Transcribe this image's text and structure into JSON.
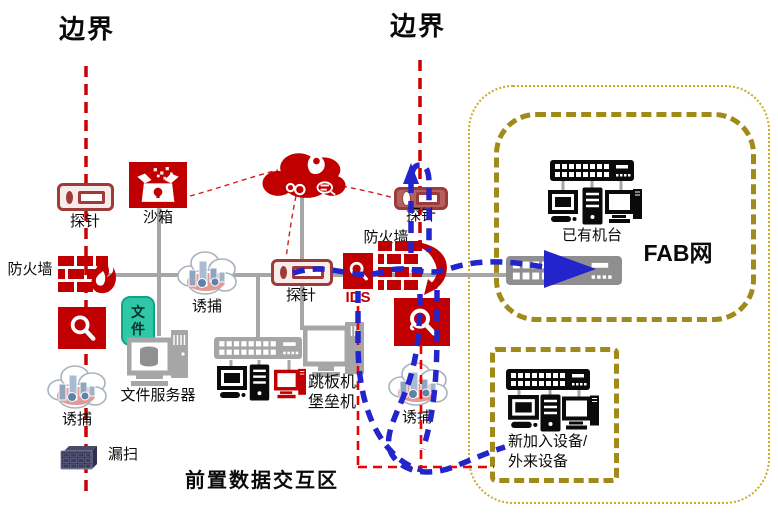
{
  "colors": {
    "accent_red": "#C00000",
    "probe_border_red": "#9E3A38",
    "detour_red": "#EE0000",
    "flow_blue": "#2424CC",
    "zone_olive": "#A18A1A",
    "zone_olive_dotted": "#C9AC28",
    "connector_gray": "#A6A6A6",
    "device_black": "#0A0A0A",
    "file_tag_teal": "#2EC8A6"
  },
  "labels": {
    "boundary_left": "边界",
    "boundary_right": "边界",
    "probe_left": "探针",
    "probe_center": "探针",
    "probe_right": "探针",
    "sandbox": "沙箱",
    "firewall_left": "防火墙",
    "firewall_right": "防火墙",
    "ids": "IDS",
    "decoy_left": "诱捕",
    "decoy_center": "诱捕",
    "decoy_bottom": "诱捕",
    "file_tag": "文件",
    "file_server": "文件服务器",
    "jump_server_line1": "跳板机/",
    "jump_server_line2": "堡垒机",
    "vuln_scan": "漏扫",
    "existing_machines": "已有机台",
    "fab_net": "FAB网",
    "new_devices_line1": "新加入设备/",
    "new_devices_line2": "外来设备",
    "front_zone": "前置数据交互区"
  }
}
